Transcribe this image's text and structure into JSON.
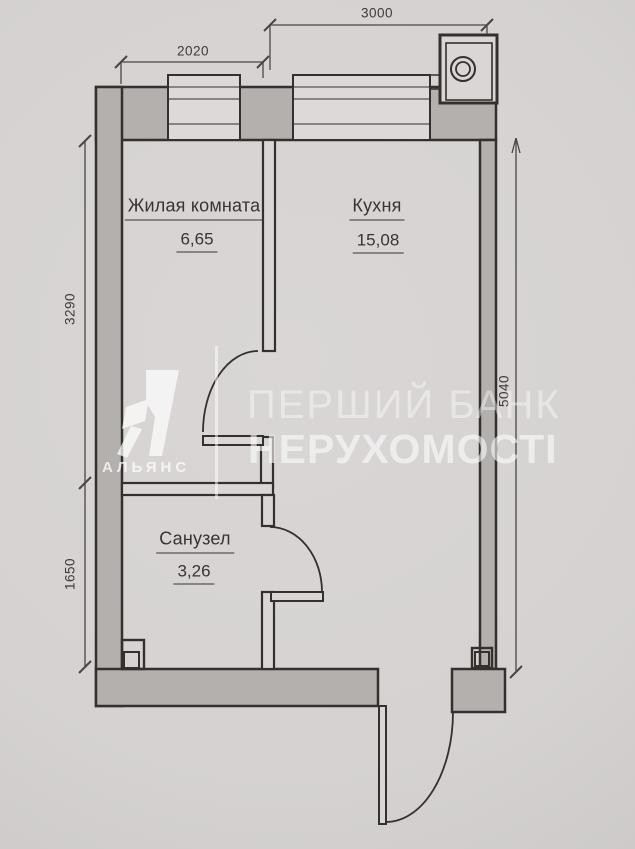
{
  "rooms": [
    {
      "name": "Жилая комната",
      "area": "6,65"
    },
    {
      "name": "Кухня",
      "area": "15,08"
    },
    {
      "name": "Санузел",
      "area": "3,26"
    }
  ],
  "dimensions": {
    "window_left": "2020",
    "top_right": "3000",
    "left_upper": "3290",
    "left_lower": "1650",
    "right_total": "5040"
  },
  "watermark": {
    "brand": "АЛЬЯНС",
    "line1": "ПЕРШИЙ БАНК",
    "line2": "НЕРУХОМОСТІ"
  },
  "colors": {
    "paper": "#d6d3d2",
    "wall_fill": "#b3b0ae",
    "interior_fill": "#d9d6d5",
    "line": "#34302d",
    "dim_line": "#4a4643",
    "watermark": "#ffffff"
  }
}
